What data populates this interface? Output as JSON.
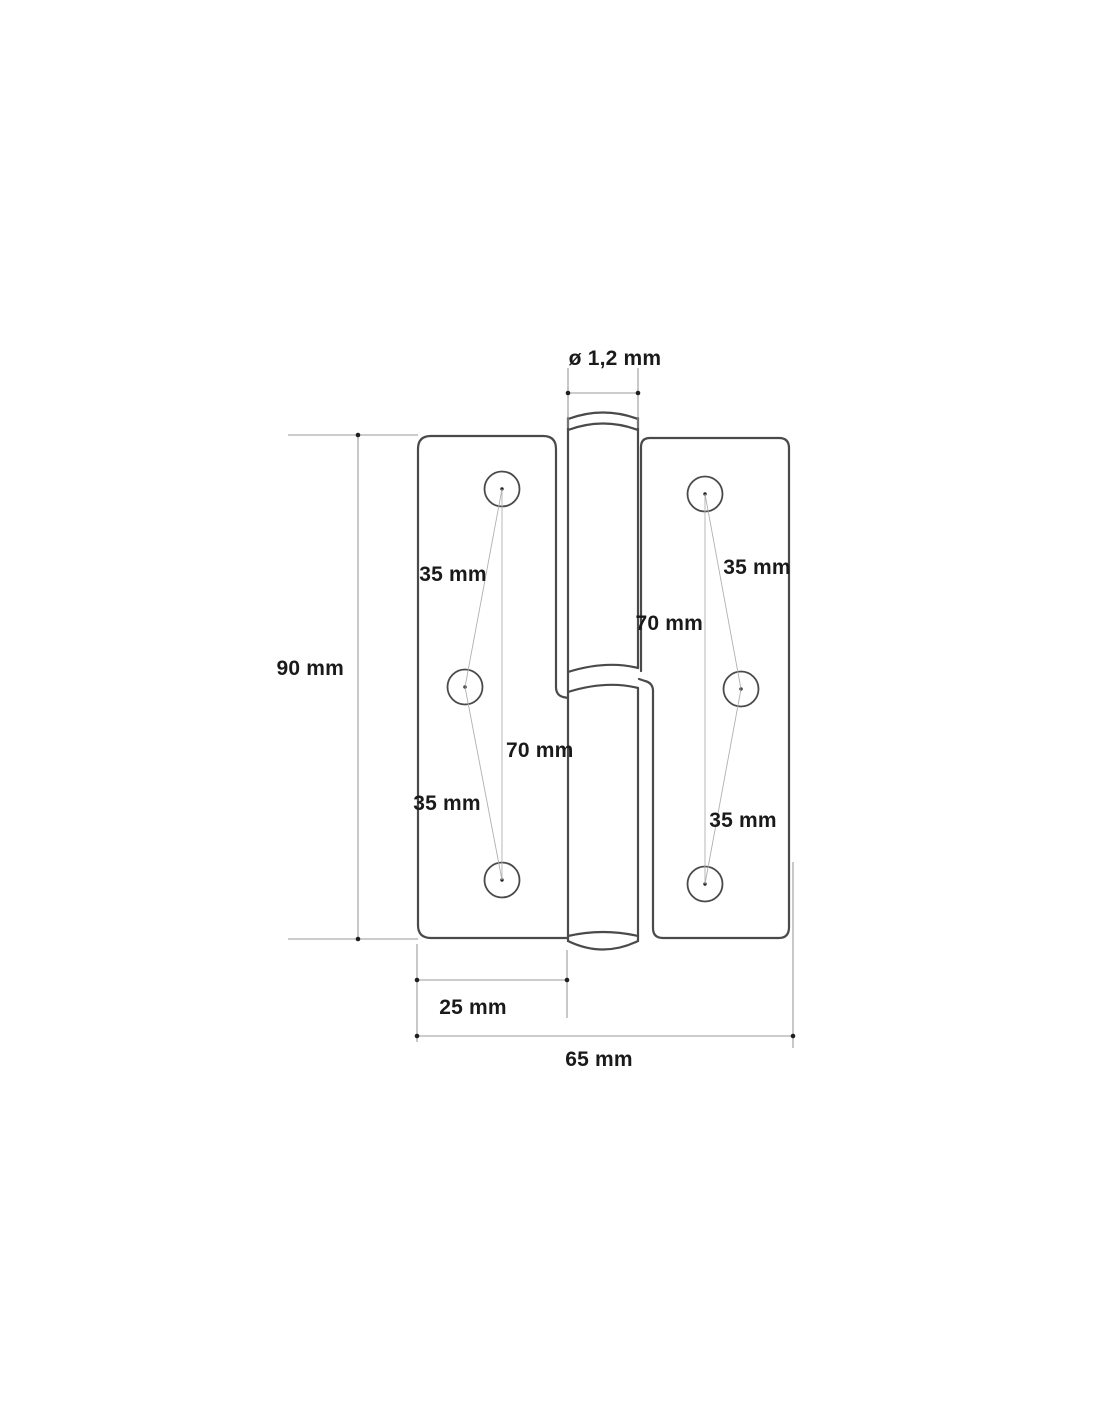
{
  "diagram": {
    "type": "technical-drawing",
    "subject": "lift-off door hinge, front view with dimension annotations",
    "labels": {
      "pin_diameter": "ø 1,2 mm",
      "total_height": "90 mm",
      "left_hole_spacing_top": "35 mm",
      "left_hole_spacing_bottom": "35 mm",
      "left_hole_span": "70 mm",
      "right_hole_spacing_top": "35 mm",
      "right_hole_spacing_bottom": "35 mm",
      "right_hole_span": "70 mm",
      "leaf_width": "25 mm",
      "total_width": "65 mm"
    },
    "counts": {
      "screw_holes_left": 3,
      "screw_holes_right": 3
    },
    "colors": {
      "background": "#ffffff",
      "outline": "#4a4a4a",
      "dimension": "#9a9a9a",
      "leader": "#b0b0b0",
      "text": "#1a1a1a"
    }
  }
}
